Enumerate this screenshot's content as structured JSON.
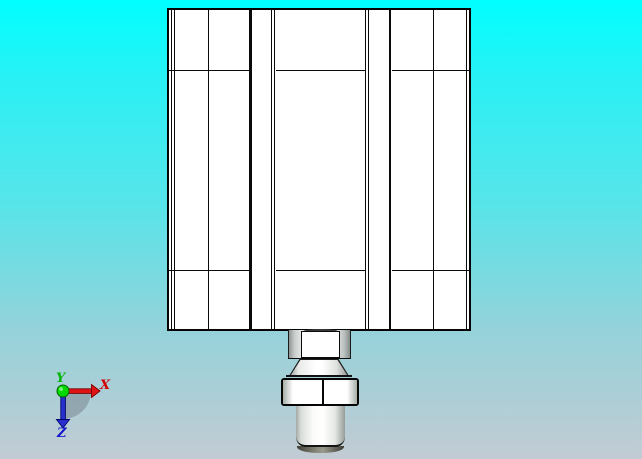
{
  "scene": {
    "type": "cad-viewport",
    "description": "Front orthographic view of a pneumatic cylinder (square tie-rod body with piston rod, gland and hex nut)",
    "background": {
      "top_color": "#00FEFE",
      "bottom_color": "#C2CBD3"
    },
    "model": {
      "body_fill": "#FFFFFF",
      "outline_color": "#050505",
      "rod_shade_color": "#969C98",
      "rod_tip_color": "#3E3E36"
    }
  },
  "axis_triad": {
    "x_label": "X",
    "y_label": "Y",
    "z_label": "Z",
    "x_color": "#D40000",
    "y_color": "#00B400",
    "z_color": "#1414CC",
    "origin_ball_color": "#00DC00",
    "shadow_color": "#6E7882"
  }
}
